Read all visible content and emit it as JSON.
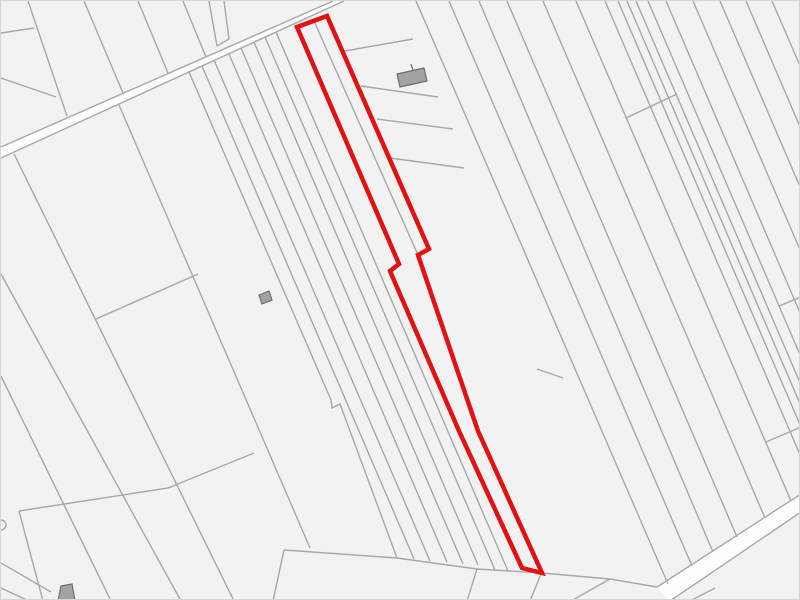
{
  "map": {
    "kind": "cadastral-parcel-map",
    "canvas": {
      "width": 800,
      "height": 600
    },
    "colors": {
      "background": "#f2f2f3",
      "road_fill": "#fdfdfd",
      "boundary_line": "#a7a7ac",
      "building_fill": "#a3a3a3",
      "building_stroke": "#6e6e6e",
      "highlight": "#e01212"
    },
    "stroke_widths": {
      "boundary": 1.4,
      "highlight": 4.5,
      "building": 1.2
    },
    "roads": [
      {
        "name": "road-upper-left",
        "fill_points": [
          [
            0,
            146
          ],
          [
            332,
            0
          ],
          [
            343,
            0
          ],
          [
            0,
            157
          ]
        ]
      },
      {
        "name": "road-lower-right",
        "fill_points": [
          [
            656,
            586
          ],
          [
            800,
            493
          ],
          [
            800,
            511
          ],
          [
            669,
            600
          ]
        ]
      }
    ],
    "boundary_segments": [
      [
        0,
        32,
        33,
        27
      ],
      [
        0,
        77,
        55,
        96
      ],
      [
        27,
        0,
        66,
        115
      ],
      [
        83,
        0,
        122,
        92
      ],
      [
        137,
        0,
        167,
        72
      ],
      [
        182,
        0,
        205,
        56
      ],
      [
        208,
        0,
        216,
        45
      ],
      [
        223,
        0,
        228,
        38
      ],
      [
        216,
        45,
        228,
        38
      ],
      [
        0,
        146,
        332,
        0
      ],
      [
        0,
        157,
        343,
        0
      ],
      [
        13,
        153,
        233,
        600
      ],
      [
        0,
        273,
        180,
        600
      ],
      [
        0,
        375,
        110,
        600
      ],
      [
        118,
        104,
        309,
        547
      ],
      [
        95,
        318,
        197,
        273
      ],
      [
        18,
        510,
        42,
        600
      ],
      [
        0,
        562,
        50,
        591
      ],
      [
        0,
        587,
        28,
        600
      ],
      [
        201,
        65,
        413,
        558
      ],
      [
        213,
        59,
        429,
        560
      ],
      [
        228,
        53,
        446,
        561
      ],
      [
        240,
        47,
        462,
        563
      ],
      [
        253,
        41,
        477,
        564
      ],
      [
        264,
        36,
        494,
        569
      ],
      [
        275,
        31,
        507,
        570
      ],
      [
        313,
        20,
        417,
        254
      ],
      [
        415,
        0,
        667,
        583
      ],
      [
        344,
        50,
        412,
        38
      ],
      [
        360,
        85,
        437,
        96
      ],
      [
        376,
        118,
        452,
        128
      ],
      [
        389,
        157,
        463,
        167
      ],
      [
        448,
        0,
        691,
        565
      ],
      [
        478,
        0,
        712,
        551
      ],
      [
        506,
        0,
        736,
        536
      ],
      [
        542,
        0,
        764,
        517
      ],
      [
        575,
        0,
        790,
        500
      ],
      [
        604,
        0,
        800,
        456
      ],
      [
        617,
        0,
        800,
        426
      ],
      [
        626,
        0,
        800,
        405
      ],
      [
        635,
        0,
        800,
        384
      ],
      [
        647,
        0,
        800,
        356
      ],
      [
        665,
        0,
        800,
        314
      ],
      [
        692,
        0,
        800,
        251
      ],
      [
        719,
        0,
        800,
        188
      ],
      [
        745,
        0,
        800,
        128
      ],
      [
        771,
        0,
        800,
        67
      ],
      [
        625,
        117,
        676,
        93
      ],
      [
        778,
        305,
        800,
        296
      ],
      [
        536,
        368,
        562,
        377
      ],
      [
        765,
        441,
        800,
        426
      ],
      [
        283,
        549,
        272,
        600
      ],
      [
        476,
        568,
        466,
        600
      ],
      [
        540,
        573,
        529,
        600
      ],
      [
        609,
        578,
        570,
        600
      ],
      [
        689,
        600,
        714,
        587
      ],
      [
        656,
        586,
        800,
        493
      ],
      [
        669,
        600,
        800,
        511
      ]
    ],
    "boundary_polylines": [
      [
        [
          18,
          510
        ],
        [
          167,
          487
        ],
        [
          253,
          452
        ]
      ],
      [
        [
          188,
          71
        ],
        [
          330,
          399
        ],
        [
          331,
          407
        ],
        [
          339,
          403
        ],
        [
          396,
          557
        ]
      ],
      [
        [
          283,
          549
        ],
        [
          396,
          557
        ],
        [
          476,
          568
        ],
        [
          541,
          572
        ],
        [
          609,
          578
        ],
        [
          656,
          586
        ]
      ]
    ],
    "buildings": [
      {
        "name": "building-north",
        "points": [
          [
            396,
            73
          ],
          [
            423,
            67
          ],
          [
            426,
            80
          ],
          [
            399,
            86
          ]
        ]
      },
      {
        "name": "building-west",
        "points": [
          [
            258,
            294
          ],
          [
            268,
            290
          ],
          [
            271,
            299
          ],
          [
            261,
            303
          ]
        ]
      },
      {
        "name": "building-southwest",
        "points": [
          [
            60,
            585
          ],
          [
            71,
            583
          ],
          [
            74,
            600
          ],
          [
            57,
            600
          ]
        ]
      }
    ],
    "building_marks": [
      [
        410,
        63,
        412,
        69
      ]
    ],
    "edge_structures": [
      {
        "name": "well-left-edge",
        "cx": 0,
        "cy": 524,
        "r": 5
      }
    ],
    "selected_parcel": {
      "name": "highlighted-parcel",
      "points": [
        [
          296,
          26
        ],
        [
          326,
          15
        ],
        [
          428,
          248
        ],
        [
          417,
          254
        ],
        [
          477,
          430
        ],
        [
          541,
          572
        ],
        [
          521,
          567
        ],
        [
          458,
          430
        ],
        [
          389,
          270
        ],
        [
          398,
          263
        ]
      ]
    }
  }
}
